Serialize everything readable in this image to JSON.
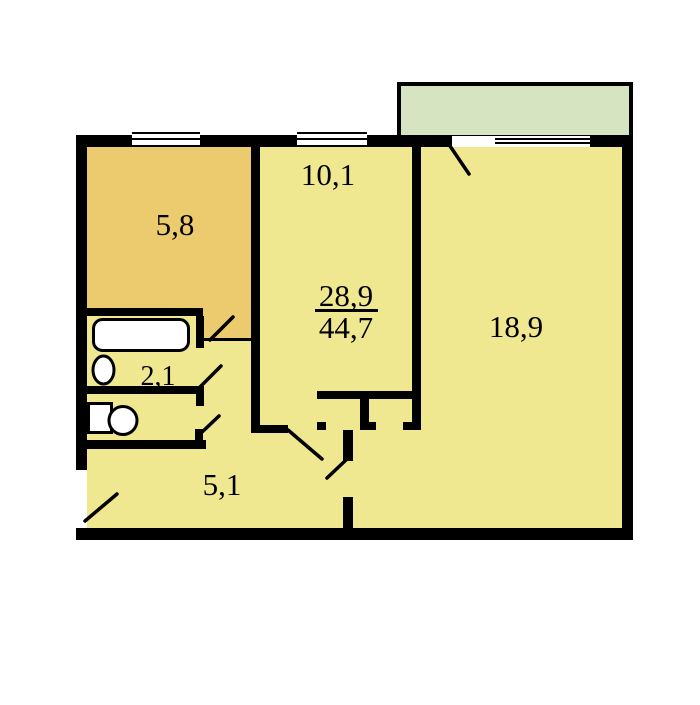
{
  "plan": {
    "type": "apartment-floor-plan",
    "labels": {
      "kitchen_area": "5,8",
      "room_small_area": "10,1",
      "room_large_area": "18,9",
      "bathroom_area": "2,1",
      "hallway_area": "5,1",
      "living_area": "28,9",
      "total_area": "44,7"
    },
    "colors": {
      "wall": "#000000",
      "interior": "#f0e890",
      "kitchen": "#ecca6e",
      "balcony": "#d7e4c2",
      "fixture": "#ffffff",
      "background": "#ffffff"
    }
  }
}
